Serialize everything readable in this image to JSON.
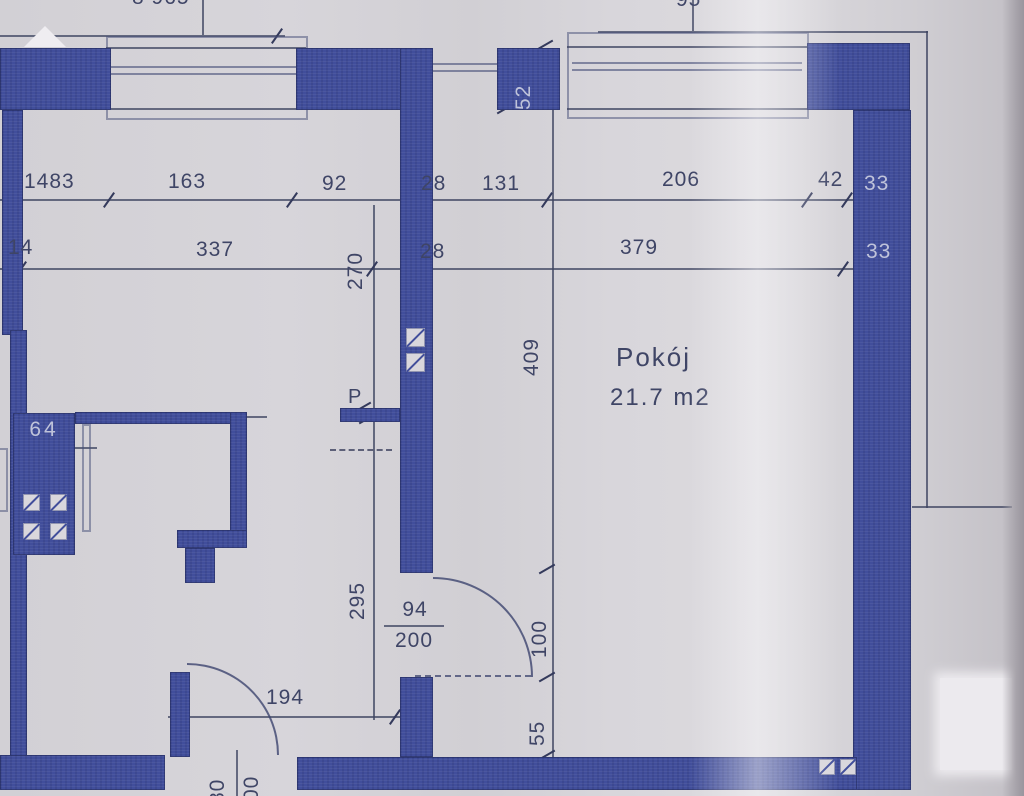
{
  "document_kind": "scanned architectural floor plan",
  "labels": {
    "row1": [
      "1483",
      "163",
      "92",
      "28",
      "131",
      "206",
      "42",
      "33"
    ],
    "row2": [
      "14",
      "337",
      "28",
      "379",
      "33"
    ],
    "vertical": {
      "pier": "52",
      "upper_left": "270",
      "lower_left": "295",
      "room_height": "409",
      "door_opening": "100",
      "below_door": "55"
    },
    "room": {
      "name": "Pokój",
      "area": "21.7 m2"
    },
    "door_main": {
      "width": "94",
      "height": "200"
    },
    "door_bottom": {
      "opening": "194",
      "width_clipped": "80",
      "height_clipped": "00"
    },
    "duct_label": "64",
    "p_mark": "P",
    "clipped_top_left": "8 965",
    "clipped_top_right": "95"
  },
  "colors": {
    "wall": "#414e9b",
    "paper": "#d5d3d7",
    "dimension_line": "#3e4460",
    "dimension_text": "#3f4566",
    "text_on_wall": "#bfc3da"
  }
}
